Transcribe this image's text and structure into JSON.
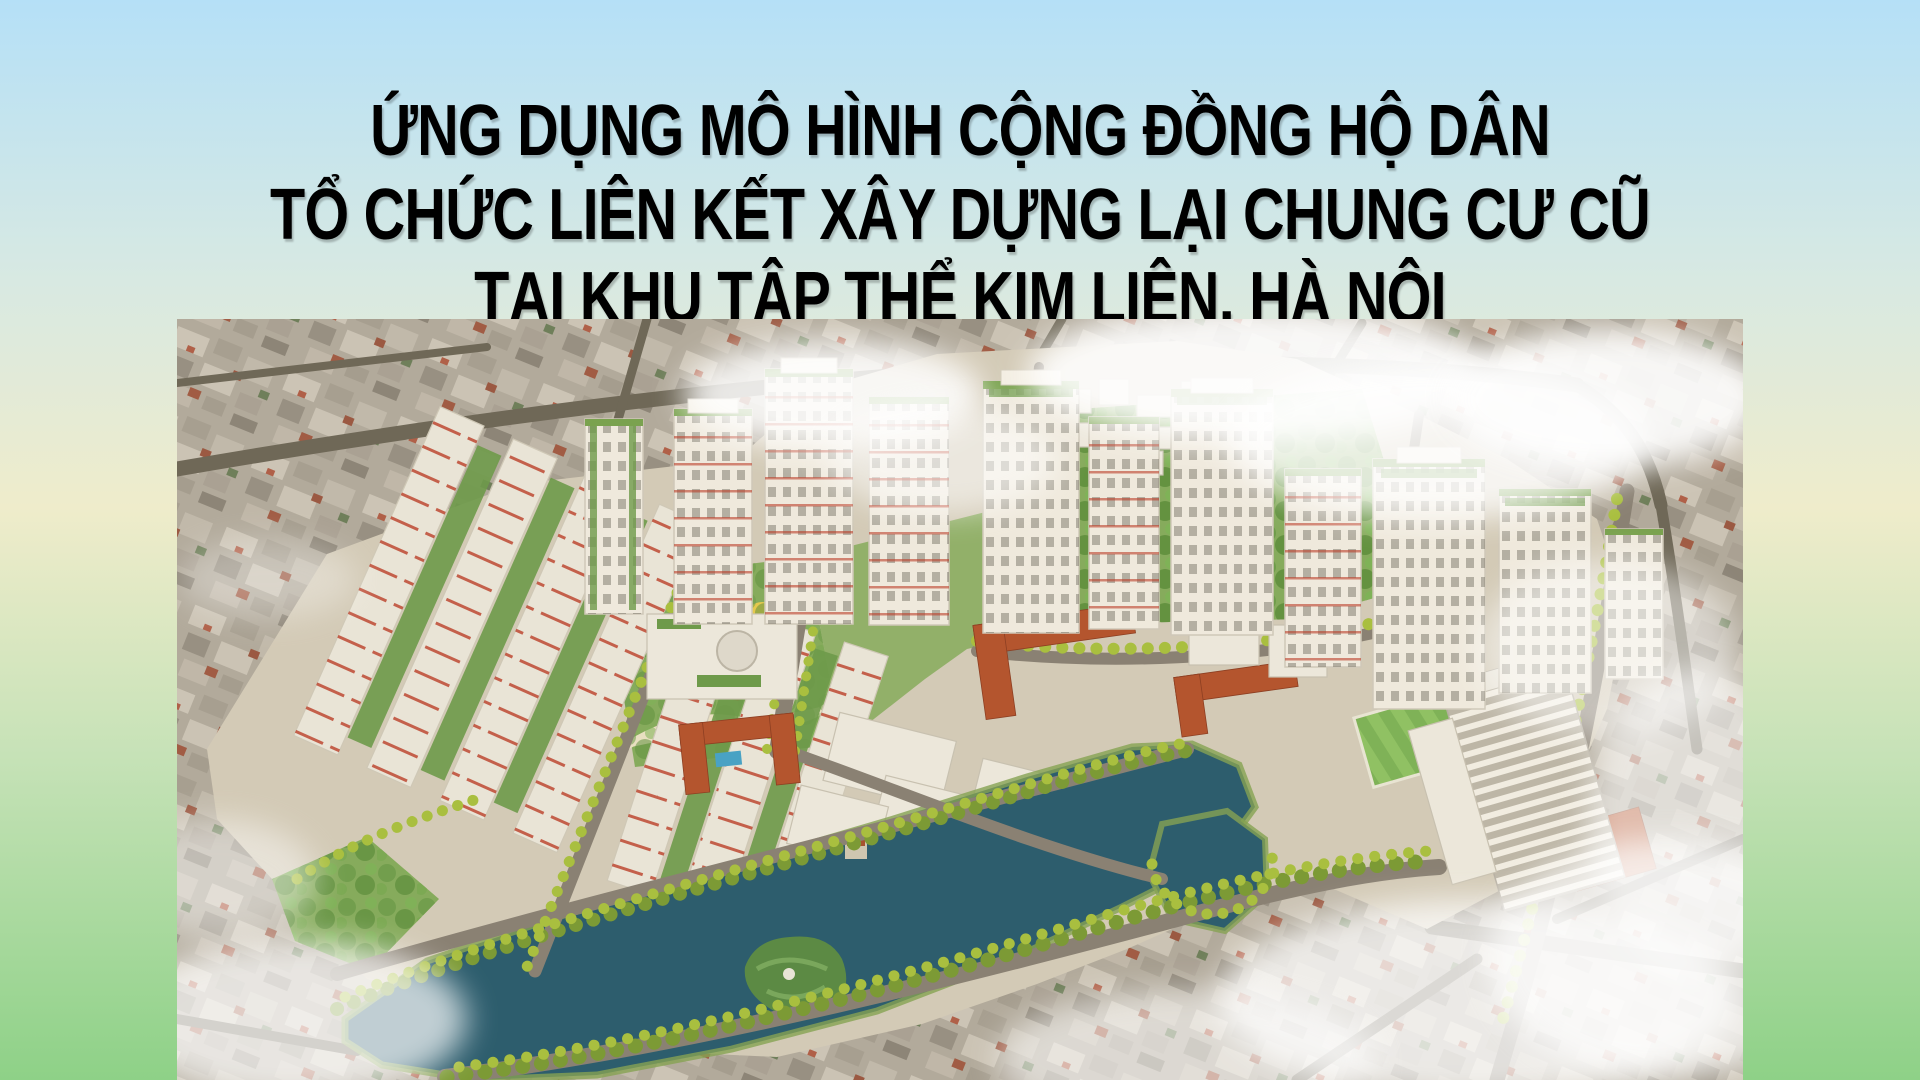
{
  "slide": {
    "title_lines": [
      "ỨNG DỤNG MÔ HÌNH CỘNG ĐỒNG HỘ DÂN",
      "TỔ CHỨC LIÊN KẾT XÂY DỰNG LẠI CHUNG CƯ CŨ",
      "TẠI KHU TẬP THỂ KIM LIÊN, HÀ NỘI"
    ],
    "title_color": "#000000",
    "background": {
      "bg_top": "#b5e0f7",
      "bg_upper": "#d8e9e2",
      "bg_mid": "#efeccb",
      "bg_lower": "#c6e2b7",
      "bg_bottom": "#8ed187"
    },
    "image": {
      "label": "aerial-masterplan-render",
      "description": "Aerial 3D rendering of the redeveloped Kim Lien collective housing quarter in Hanoi: white high-rise towers with green accents, long residential slabs, parks, tree-lined streets, a large lake with a green island, red-roofed schools, surrounded by the dense existing city under light clouds",
      "colors": {
        "lake": "#2d5d6d",
        "park": "#86ab5c",
        "tree": "#a9bf3f",
        "building": "#ece7da",
        "roof_red": "#b4552e",
        "road": "#8a8173",
        "city": "#b2aa9b",
        "cloud": "#ffffff"
      }
    }
  }
}
